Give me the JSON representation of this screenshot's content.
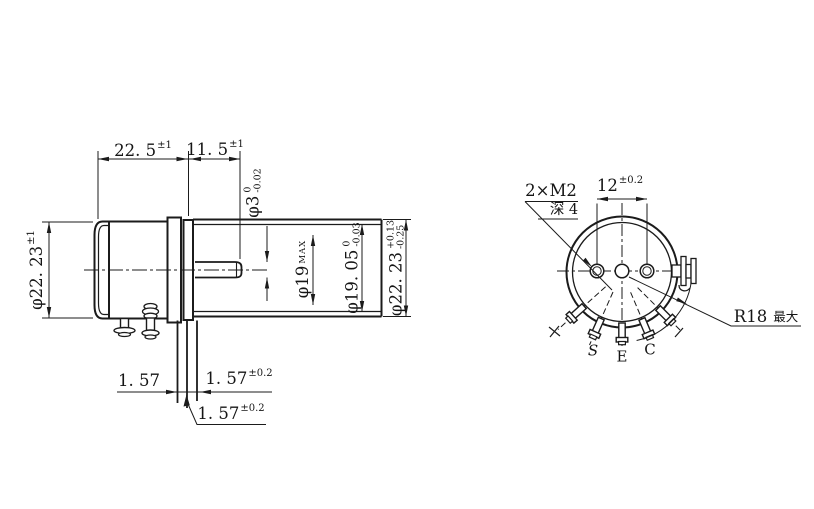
{
  "labels": {
    "body_length": {
      "value": "22. 5",
      "tol": "±1"
    },
    "shaft_length": {
      "value": "11. 5",
      "tol": "±1"
    },
    "shaft_dia": {
      "value": "φ3",
      "tol_top": "0",
      "tol_bot": "-0.02"
    },
    "bore_dia": {
      "value": "φ19",
      "suffix": "MAX"
    },
    "inner_dia": {
      "value": "φ19. 05",
      "tol_top": "0",
      "tol_bot": "-0.03"
    },
    "outer_dia": {
      "value": "φ22. 23",
      "tol_top": "+0.13",
      "tol_bot": "-0.25"
    },
    "cap_dia": {
      "value": "φ22. 23",
      "tol": "±1"
    },
    "lead_pitch_a": {
      "value": "1. 57"
    },
    "lead_pitch_b": {
      "value": "1. 57",
      "tol": "±0.2"
    },
    "lead_pitch_c": {
      "value": "1. 57",
      "tol": "±0.2"
    },
    "hole_spacing": {
      "value": "12",
      "tol": "±0.2"
    },
    "thread_note": {
      "line1": "2×M2",
      "line2": "深 4"
    },
    "radius_note": {
      "value": "R18",
      "suffix": "最大"
    },
    "pins": {
      "s": "S",
      "e": "E",
      "c": "C"
    }
  },
  "colors": {
    "line": "#1b1b1b",
    "background": "#ffffff"
  }
}
